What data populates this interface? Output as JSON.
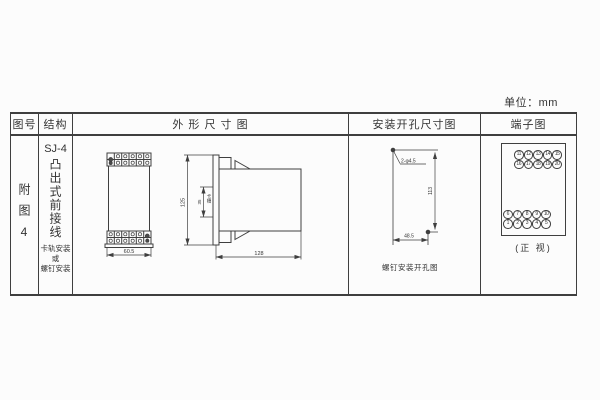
{
  "unit_label": "单位：mm",
  "table": {
    "headers": {
      "figure_no": "图号",
      "structure": "结构",
      "outline": "外 形 尺 寸 图",
      "mounting": "安装开孔尺寸图",
      "terminal": "端子图"
    },
    "row": {
      "figure_no": "附图4",
      "structure": {
        "model": "SJ-4",
        "type_vertical": "凸出式前接线",
        "mount_note": [
          "卡轨安装",
          "或",
          "螺钉安装"
        ]
      }
    }
  },
  "outline_drawing": {
    "front_width": "60.5",
    "height": "125",
    "slot_height": "35",
    "slot_label": "卡槽",
    "depth": "128"
  },
  "mounting_drawing": {
    "holes_label": "2-φ4.5",
    "vertical_spacing": "113",
    "horizontal_spacing": "48.5",
    "caption": "螺钉安装开孔图"
  },
  "terminal_diagram": {
    "rows": [
      [
        "11",
        "12",
        "13",
        "14",
        "15"
      ],
      [
        "16",
        "17",
        "18",
        "19",
        "20"
      ],
      [
        "6",
        "7",
        "8",
        "9",
        "10"
      ],
      [
        "1",
        "2",
        "3",
        "4",
        "5"
      ]
    ],
    "caption": "(正 视)"
  },
  "colors": {
    "line": "#3f3f3f",
    "text": "#333333",
    "background": "#fcfcfc"
  }
}
